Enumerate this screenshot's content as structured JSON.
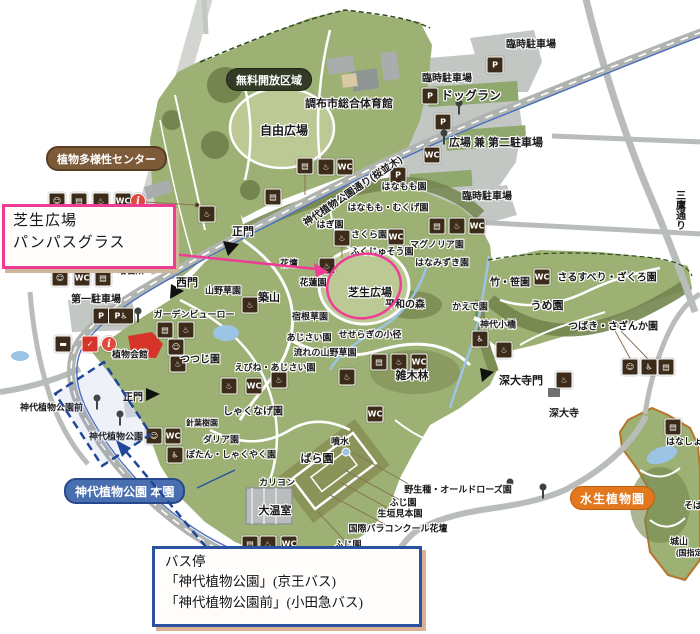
{
  "colors": {
    "pink_accent": "#ef3d96",
    "blue_accent": "#1f4699",
    "park_green": "#9cb173",
    "lawn_green": "#bcc994",
    "forest_green": "#74854f",
    "road_gray": "#b9bdb9",
    "water_blue": "#9cc4e4",
    "badge_dark": "#333b26",
    "badge_brown": "#7d5a38",
    "badge_blue": "#4a6fb0",
    "badge_orange": "#e2771d",
    "icon_brown": "#3b2b18",
    "info_red": "#e04a3c"
  },
  "annotations": {
    "lawn_box": {
      "line1": "芝生広場",
      "line2": "パンパスグラス"
    },
    "bus_box": {
      "title": "バス停",
      "line1": "「神代植物公園」(京王バス)",
      "line2": "「神代植物公園前」(小田急バス)"
    }
  },
  "map": {
    "badges": [
      {
        "text": "無料開放区域",
        "x": 226,
        "y": 68,
        "style": "dark"
      },
      {
        "text": "植物多様性センター",
        "x": 46,
        "y": 146,
        "style": "brown"
      },
      {
        "text": "神代植物公園 本園",
        "x": 64,
        "y": 478,
        "style": "blue"
      },
      {
        "text": "水生植物園",
        "x": 570,
        "y": 486,
        "style": "orange"
      }
    ],
    "labels": [
      {
        "t": "臨時駐車場",
        "x": 531,
        "y": 43
      },
      {
        "t": "臨時駐車場",
        "x": 447,
        "y": 77
      },
      {
        "t": "ドッグラン",
        "x": 471,
        "y": 95,
        "s": 12
      },
      {
        "t": "広場 兼 第二駐車場",
        "x": 496,
        "y": 142,
        "s": 11
      },
      {
        "t": "臨時駐車場",
        "x": 487,
        "y": 195
      },
      {
        "t": "調布市総合体育館",
        "x": 349,
        "y": 103,
        "s": 11
      },
      {
        "t": "自由広場",
        "x": 284,
        "y": 130,
        "s": 12
      },
      {
        "t": "はなもも園",
        "x": 404,
        "y": 186,
        "s": 9
      },
      {
        "t": "はなもも・むくげ園",
        "x": 388,
        "y": 207,
        "s": 9
      },
      {
        "t": "はぎ園",
        "x": 330,
        "y": 224,
        "s": 9
      },
      {
        "t": "さくら園",
        "x": 369,
        "y": 234,
        "s": 9
      },
      {
        "t": "ふくじゅそう園",
        "x": 382,
        "y": 251,
        "s": 9
      },
      {
        "t": "マグノリア園",
        "x": 437,
        "y": 244,
        "s": 9
      },
      {
        "t": "はなみずき園",
        "x": 442,
        "y": 262,
        "s": 9
      },
      {
        "t": "正門",
        "x": 243,
        "y": 231,
        "s": 11
      },
      {
        "t": "花壇",
        "x": 289,
        "y": 263,
        "s": 9
      },
      {
        "t": "花蓮園",
        "x": 313,
        "y": 282,
        "s": 9
      },
      {
        "t": "芝生広場",
        "x": 370,
        "y": 292,
        "s": 11
      },
      {
        "t": "平和の森",
        "x": 405,
        "y": 303,
        "s": 10
      },
      {
        "t": "かえで園",
        "x": 470,
        "y": 306,
        "s": 9
      },
      {
        "t": "築山",
        "x": 269,
        "y": 297,
        "s": 11
      },
      {
        "t": "宿根草園",
        "x": 310,
        "y": 316,
        "s": 9
      },
      {
        "t": "あじさい園",
        "x": 309,
        "y": 337,
        "s": 9
      },
      {
        "t": "せせらぎの小径",
        "x": 370,
        "y": 334,
        "s": 9
      },
      {
        "t": "流れの山野草園",
        "x": 325,
        "y": 352,
        "s": 9
      },
      {
        "t": "えびね・あじさい園",
        "x": 275,
        "y": 367,
        "s": 9
      },
      {
        "t": "神代小橋",
        "x": 498,
        "y": 324,
        "s": 9
      },
      {
        "t": "竹・笹園",
        "x": 510,
        "y": 281,
        "s": 10
      },
      {
        "t": "さるすべり・ざくろ園",
        "x": 607,
        "y": 276,
        "s": 10
      },
      {
        "t": "うめ園",
        "x": 547,
        "y": 305,
        "s": 11
      },
      {
        "t": "つばき・さざんか園",
        "x": 613,
        "y": 325,
        "s": 10
      },
      {
        "t": "深大寺門",
        "x": 521,
        "y": 380,
        "s": 11
      },
      {
        "t": "深大寺",
        "x": 564,
        "y": 412,
        "s": 10
      },
      {
        "t": "雑木林",
        "x": 412,
        "y": 375,
        "s": 11
      },
      {
        "t": "培養所",
        "x": 131,
        "y": 270,
        "s": 9
      },
      {
        "t": "西門",
        "x": 187,
        "y": 282,
        "s": 11
      },
      {
        "t": "山野草園",
        "x": 223,
        "y": 290,
        "s": 9
      },
      {
        "t": "第一駐車場",
        "x": 96,
        "y": 298,
        "s": 10
      },
      {
        "t": "ガーデンビューロー",
        "x": 194,
        "y": 314,
        "s": 9
      },
      {
        "t": "植物会館",
        "x": 130,
        "y": 354,
        "s": 9
      },
      {
        "t": "つつじ園",
        "x": 200,
        "y": 358,
        "s": 10
      },
      {
        "t": "しゃくなげ園",
        "x": 253,
        "y": 410,
        "s": 10
      },
      {
        "t": "針葉樹園",
        "x": 202,
        "y": 423,
        "s": 8
      },
      {
        "t": "ダリア園",
        "x": 221,
        "y": 439,
        "s": 9
      },
      {
        "t": "ぼたん・しゃくやく園",
        "x": 231,
        "y": 454,
        "s": 9
      },
      {
        "t": "カリヨン",
        "x": 277,
        "y": 482,
        "s": 9
      },
      {
        "t": "大温室",
        "x": 275,
        "y": 510,
        "s": 11
      },
      {
        "t": "ばら園",
        "x": 317,
        "y": 458,
        "s": 11
      },
      {
        "t": "噴水",
        "x": 340,
        "y": 441,
        "s": 9
      },
      {
        "t": "正門",
        "x": 133,
        "y": 396,
        "s": 10
      },
      {
        "t": "神代植物公園前",
        "x": 20,
        "y": 407,
        "s": 9,
        "a": "left"
      },
      {
        "t": "神代植物公園",
        "x": 116,
        "y": 436,
        "s": 9
      },
      {
        "t": "野生種・オールドローズ園",
        "x": 458,
        "y": 489,
        "s": 9
      },
      {
        "t": "ふじ園",
        "x": 403,
        "y": 502,
        "s": 9
      },
      {
        "t": "生垣見本園",
        "x": 400,
        "y": 513,
        "s": 9
      },
      {
        "t": "国際バラコンクール花壇",
        "x": 398,
        "y": 528,
        "s": 9
      },
      {
        "t": "ふじ園",
        "x": 348,
        "y": 544,
        "s": 9
      },
      {
        "t": "はなしょうぶ園",
        "x": 666,
        "y": 441,
        "s": 9,
        "a": "left"
      },
      {
        "t": "そば畑",
        "x": 684,
        "y": 505,
        "s": 9,
        "a": "left"
      },
      {
        "t": "城山",
        "x": 670,
        "y": 541,
        "s": 9,
        "a": "left"
      },
      {
        "t": "(国指定",
        "x": 676,
        "y": 553,
        "s": 8,
        "a": "left"
      },
      {
        "t": "神代植物公園通り(桜並木)",
        "x": 352,
        "y": 190,
        "s": 10,
        "r": -34
      },
      {
        "t": "三鷹通り",
        "x": 679,
        "y": 210,
        "s": 10,
        "v": true
      }
    ],
    "icons": [
      {
        "type": "baby",
        "x": 57,
        "y": 201
      },
      {
        "type": "vending",
        "x": 79,
        "y": 201
      },
      {
        "type": "water",
        "x": 101,
        "y": 201
      },
      {
        "type": "toilet",
        "x": 123,
        "y": 201
      },
      {
        "type": "info",
        "x": 138,
        "y": 201
      },
      {
        "type": "water",
        "x": 207,
        "y": 214
      },
      {
        "type": "vending",
        "x": 273,
        "y": 197
      },
      {
        "type": "vending",
        "x": 305,
        "y": 166
      },
      {
        "type": "water",
        "x": 326,
        "y": 167
      },
      {
        "type": "toilet",
        "x": 345,
        "y": 167
      },
      {
        "type": "parking",
        "x": 430,
        "y": 96
      },
      {
        "type": "parking",
        "x": 495,
        "y": 65
      },
      {
        "type": "parking",
        "x": 443,
        "y": 122
      },
      {
        "type": "parking",
        "x": 398,
        "y": 175
      },
      {
        "type": "toilet",
        "x": 432,
        "y": 155
      },
      {
        "type": "vending",
        "x": 437,
        "y": 226
      },
      {
        "type": "water",
        "x": 457,
        "y": 226
      },
      {
        "type": "toilet",
        "x": 477,
        "y": 226
      },
      {
        "type": "water",
        "x": 342,
        "y": 238
      },
      {
        "type": "toilet",
        "x": 396,
        "y": 237
      },
      {
        "type": "water",
        "x": 327,
        "y": 266
      },
      {
        "type": "water",
        "x": 250,
        "y": 305
      },
      {
        "type": "baby",
        "x": 60,
        "y": 278
      },
      {
        "type": "toilet",
        "x": 82,
        "y": 278
      },
      {
        "type": "vending",
        "x": 103,
        "y": 278
      },
      {
        "type": "parking",
        "x": 101,
        "y": 316
      },
      {
        "type": "parkacc",
        "x": 121,
        "y": 316
      },
      {
        "type": "shop",
        "x": 165,
        "y": 330
      },
      {
        "type": "water",
        "x": 186,
        "y": 330
      },
      {
        "type": "baby",
        "x": 176,
        "y": 347
      },
      {
        "type": "bench",
        "x": 63,
        "y": 344
      },
      {
        "type": "check",
        "x": 90,
        "y": 344
      },
      {
        "type": "info",
        "x": 109,
        "y": 344
      },
      {
        "type": "water",
        "x": 178,
        "y": 364
      },
      {
        "type": "water",
        "x": 229,
        "y": 386
      },
      {
        "type": "toilet",
        "x": 254,
        "y": 386
      },
      {
        "type": "baby",
        "x": 154,
        "y": 436
      },
      {
        "type": "toilet",
        "x": 173,
        "y": 436
      },
      {
        "type": "accessible",
        "x": 175,
        "y": 455
      },
      {
        "type": "vending",
        "x": 250,
        "y": 544
      },
      {
        "type": "water",
        "x": 268,
        "y": 544
      },
      {
        "type": "toilet",
        "x": 289,
        "y": 544
      },
      {
        "type": "water",
        "x": 279,
        "y": 380
      },
      {
        "type": "water",
        "x": 347,
        "y": 377
      },
      {
        "type": "vending",
        "x": 379,
        "y": 362
      },
      {
        "type": "water",
        "x": 399,
        "y": 362
      },
      {
        "type": "toilet",
        "x": 419,
        "y": 362
      },
      {
        "type": "toilet",
        "x": 375,
        "y": 414
      },
      {
        "type": "accessible",
        "x": 480,
        "y": 339
      },
      {
        "type": "water",
        "x": 504,
        "y": 350
      },
      {
        "type": "toilet",
        "x": 542,
        "y": 277
      },
      {
        "type": "water",
        "x": 564,
        "y": 380
      },
      {
        "type": "baby",
        "x": 630,
        "y": 367
      },
      {
        "type": "accessible",
        "x": 649,
        "y": 367
      },
      {
        "type": "vending",
        "x": 666,
        "y": 367
      },
      {
        "type": "shop",
        "x": 673,
        "y": 427
      },
      {
        "type": "pole",
        "x": 138,
        "y": 315
      },
      {
        "type": "pole",
        "x": 97,
        "y": 402
      },
      {
        "type": "pole",
        "x": 120,
        "y": 418
      },
      {
        "type": "pole",
        "x": 459,
        "y": 107
      },
      {
        "type": "pole",
        "x": 444,
        "y": 137
      },
      {
        "type": "pole",
        "x": 510,
        "y": 486
      },
      {
        "type": "pole",
        "x": 543,
        "y": 491
      }
    ],
    "icon_glyphs": {
      "parking": "P",
      "parkacc": "P♿",
      "toilet": "WC",
      "accessible": "♿",
      "water": "♨",
      "vending": "▤",
      "baby": "☺",
      "bench": "▬",
      "shop": "▤",
      "info": "i",
      "check": "✓",
      "pole": ""
    }
  }
}
